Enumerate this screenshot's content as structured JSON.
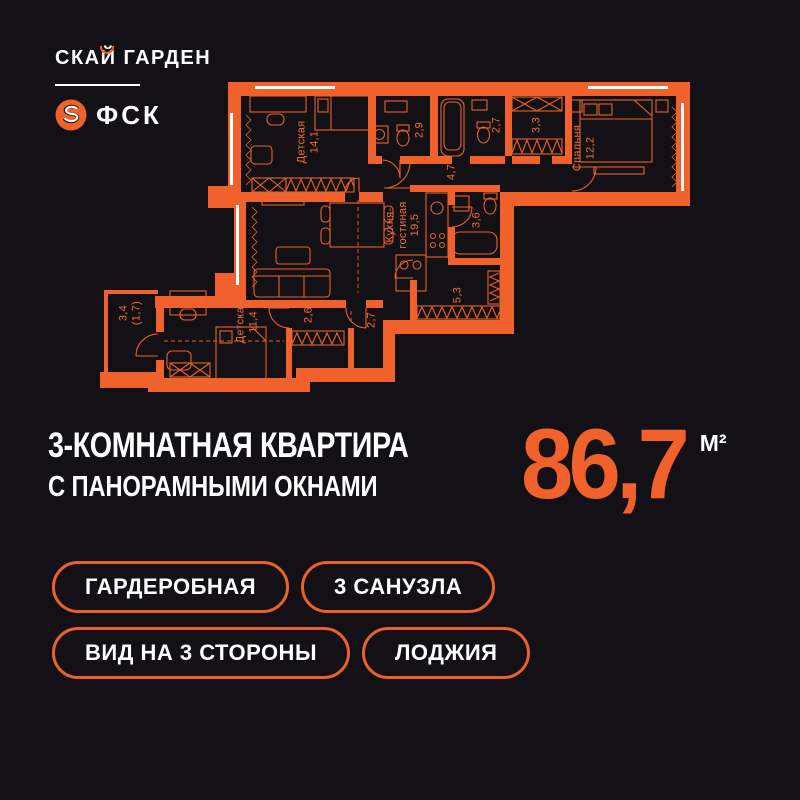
{
  "colors": {
    "background": "#131116",
    "orange": "#F1612B",
    "white": "#FFFFFF"
  },
  "header": {
    "project_name": "СКАЙ ГАРДЕН",
    "developer_name": "ФСК",
    "developer_icon": "fsk-s-ring-icon"
  },
  "plan": {
    "rooms": [
      {
        "name": "Детская",
        "area": "14,1"
      },
      {
        "name": "",
        "area": "2,9"
      },
      {
        "name": "",
        "area": "2,7"
      },
      {
        "name": "",
        "area": "3,3"
      },
      {
        "name": "Спальня",
        "area": "12,2"
      },
      {
        "name": "",
        "area": "4,7"
      },
      {
        "name": "Кухня-\nгостиная",
        "area": "19,5"
      },
      {
        "name": "",
        "area": "3,6"
      },
      {
        "name": "",
        "area": "5,3"
      },
      {
        "name": "",
        "area": "2,6"
      },
      {
        "name": "",
        "area": "2,7"
      },
      {
        "name": "Детская",
        "area": "11,4"
      },
      {
        "name": "3,4",
        "area": "(1,7)"
      }
    ]
  },
  "title": {
    "line1": "3-КОМНАТНАЯ КВАРТИРА",
    "line2": "С ПАНОРАМНЫМИ ОКНАМИ"
  },
  "area": {
    "value": "86,7",
    "unit": "М²"
  },
  "badges": [
    {
      "label": "ГАРДЕРОБНАЯ"
    },
    {
      "label": "3 САНУЗЛА"
    },
    {
      "label": "ВИД НА 3 СТОРОНЫ"
    },
    {
      "label": "ЛОДЖИЯ"
    }
  ]
}
